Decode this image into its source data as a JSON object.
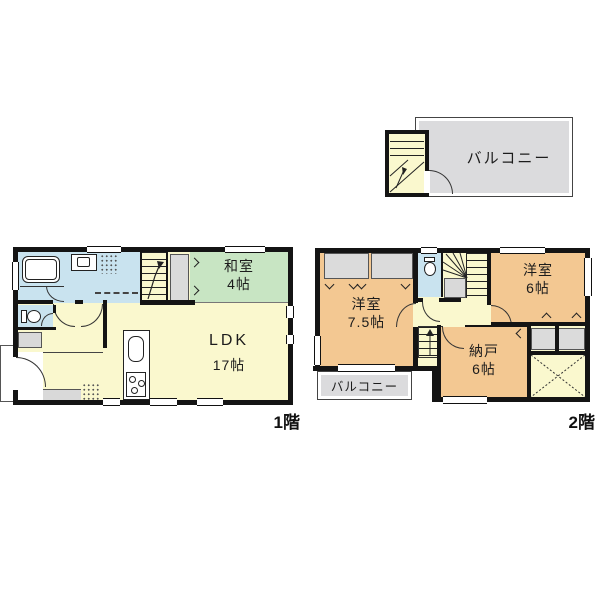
{
  "colors": {
    "wall": "#141414",
    "floor_yellow": "#FAF8CE",
    "tatami_green": "#C8E5C3",
    "wet_blue": "#C9E3EF",
    "western_orange": "#F3C892",
    "balcony_gray": "#DBDBDD",
    "closet_gray": "#DBDBDB"
  },
  "icons": [
    "bathtub-icon",
    "washing-machine-icon",
    "toilet-icon",
    "kitchen-sink-icon",
    "stove-icon",
    "stairs",
    "door-arc",
    "window",
    "x-closet-mark"
  ],
  "roof": {
    "balcony_label": "バルコニー"
  },
  "floor1": {
    "label": "1階",
    "washitsu_name": "和室",
    "washitsu_size": "4帖",
    "ldk_name": "LDK",
    "ldk_size": "17帖"
  },
  "floor2": {
    "label": "2階",
    "yoshitsu_a_name": "洋室",
    "yoshitsu_a_size": "7.5帖",
    "yoshitsu_b_name": "洋室",
    "yoshitsu_b_size": "6帖",
    "nando_name": "納戸",
    "nando_size": "6帖",
    "balcony_label": "バルコニー"
  }
}
